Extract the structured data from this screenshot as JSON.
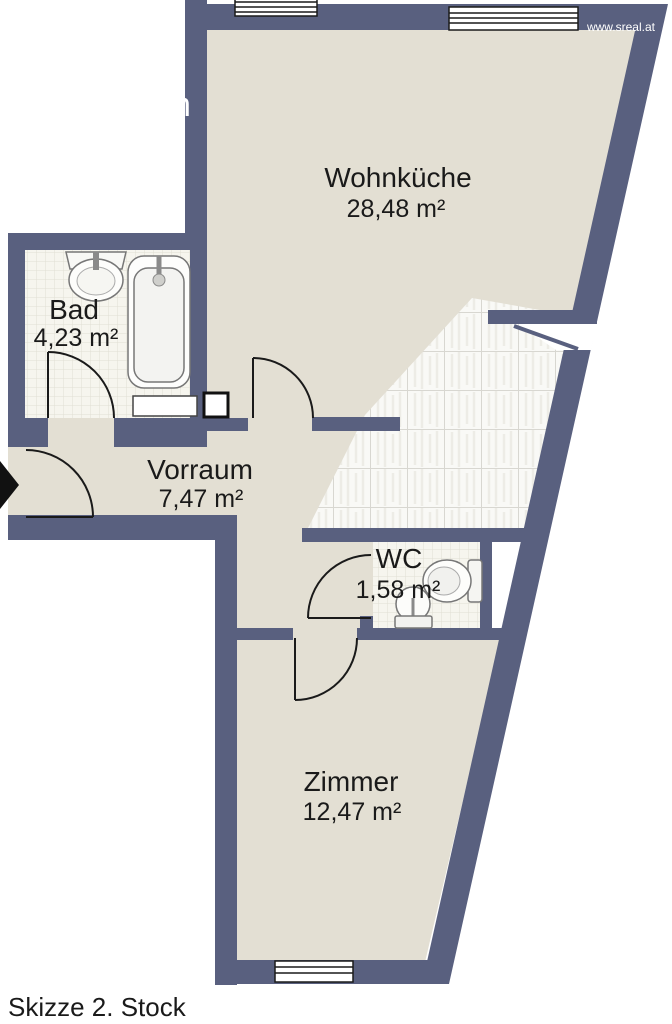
{
  "plan": {
    "footer_label": "Skizze 2. Stock",
    "watermark": "www.sreal.at",
    "watermark_fragment": "n",
    "rooms": [
      {
        "id": "wohnkueche",
        "name": "Wohnküche",
        "area": "28,48 m²"
      },
      {
        "id": "bad",
        "name": "Bad",
        "area": "4,23 m²"
      },
      {
        "id": "vorraum",
        "name": "Vorraum",
        "area": "7,47 m²"
      },
      {
        "id": "wc",
        "name": "WC",
        "area": "1,58 m²"
      },
      {
        "id": "zimmer",
        "name": "Zimmer",
        "area": "12,47 m²"
      }
    ],
    "colors": {
      "wall": "#59607F",
      "floor": "#E3DFD3",
      "tile": "#F9F9F6",
      "text": "#1A1A1A",
      "watermark_text": "#FFFFFF"
    },
    "fixtures": [
      {
        "name": "bathtub",
        "room": "Bad"
      },
      {
        "name": "washbasin",
        "room": "Bad"
      },
      {
        "name": "toilet",
        "room": "WC"
      },
      {
        "name": "corner-basin",
        "room": "WC"
      }
    ],
    "doors": [
      "entrance",
      "bad-door",
      "wohnkueche-door",
      "wc-door",
      "zimmer-door"
    ],
    "window_count": 3
  }
}
